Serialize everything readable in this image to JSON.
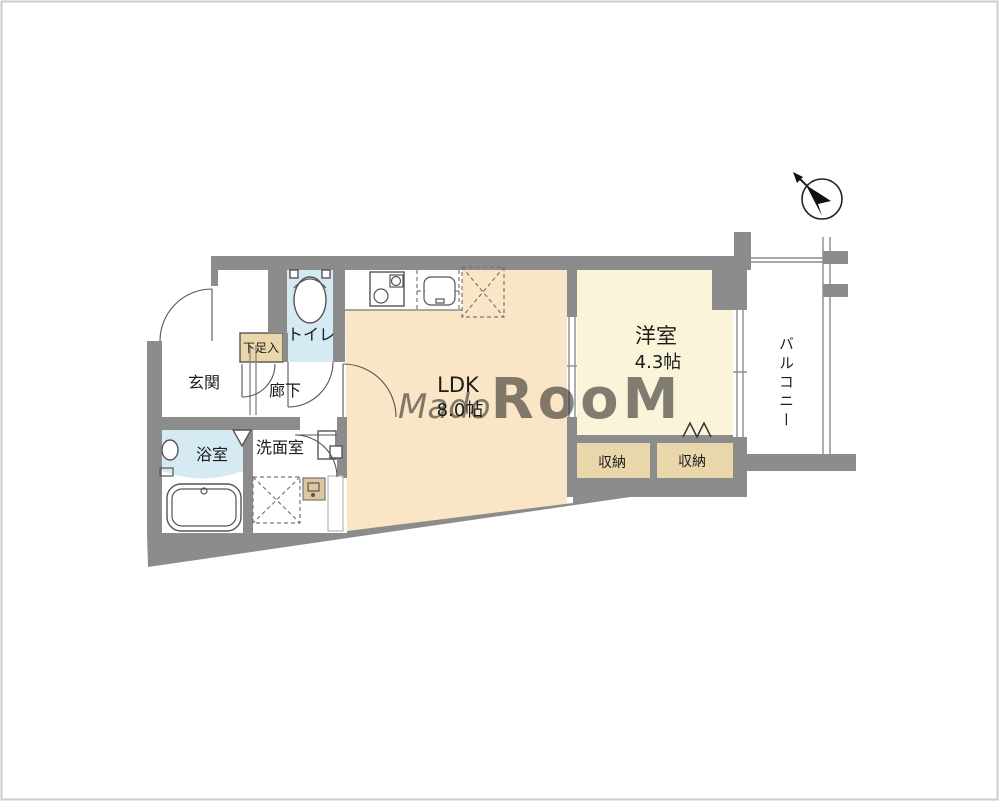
{
  "canvas": {
    "width": 999,
    "height": 801
  },
  "colors": {
    "wall": "#8c8c8c",
    "ldk_floor": "#fae6c7",
    "western_floor": "#faf4d8",
    "storage_floor": "#e9d6aa",
    "water_floor": "#d5eaf2",
    "utility_box": "#dfc69e",
    "watermark": "#ffffff",
    "frame": "#cccccc"
  },
  "rooms": {
    "entrance": {
      "label": "玄関"
    },
    "shoe_box": {
      "label": "下足入"
    },
    "toilet": {
      "label": "トイレ"
    },
    "hallway": {
      "label": "廊下"
    },
    "bathroom": {
      "label": "浴室"
    },
    "washroom": {
      "label": "洗面室"
    },
    "ldk": {
      "label": "LDK",
      "size": "8.0帖"
    },
    "western_room": {
      "label": "洋室",
      "size": "4.3帖"
    },
    "storage_left": {
      "label": "収納"
    },
    "storage_right": {
      "label": "収納"
    },
    "balcony": {
      "label": "バルコニー"
    }
  },
  "watermark": {
    "prefix": "Mado",
    "suffix": "RooM"
  },
  "icons": {
    "compass": "north-arrow-icon",
    "fixtures": [
      "toilet-icon",
      "stove-icon",
      "kitchen-sink-icon",
      "refrigerator-space-icon",
      "washing-machine-space-icon",
      "bathtub-icon",
      "bath-sink-icon",
      "vanity-icon",
      "water-heater-icon"
    ]
  }
}
